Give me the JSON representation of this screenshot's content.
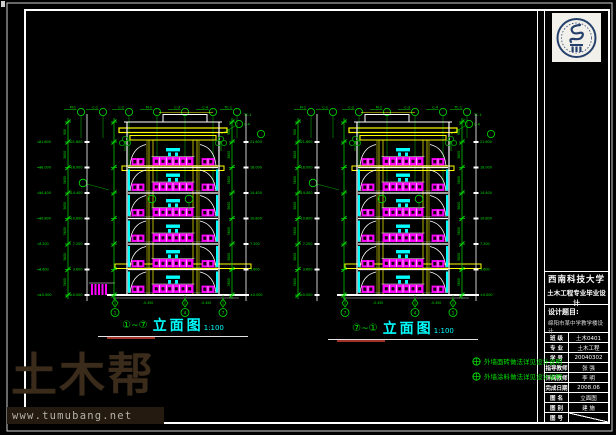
{
  "colors": {
    "bg": "#000000",
    "white": "#ffffff",
    "green": "#00E000",
    "magenta": "#FF00FF",
    "yellow": "#FFFF00",
    "cyan": "#00FFFF",
    "watermark_brown": "#3a2b1a"
  },
  "watermark": {
    "brand": "土木帮",
    "url": "www.tumubang.net"
  },
  "logo": {
    "alt": "西南科技大学校徽"
  },
  "title_block": {
    "university": "西南科技大学",
    "program": "土木工程专业毕业设计",
    "subject_label": "设计题目:",
    "subject": "绵阳市某中学教学楼设计",
    "rows": [
      {
        "label": "班 级",
        "value": "土木0401"
      },
      {
        "label": "专 业",
        "value": "土木工程"
      },
      {
        "label": "学 号",
        "value": "20040302"
      },
      {
        "label": "指导教师",
        "value": "张 强"
      },
      {
        "label": "评阅教师",
        "value": "李 明"
      },
      {
        "label": "完成日期",
        "value": "2008.06"
      },
      {
        "label": "图 名",
        "value": "立面图"
      },
      {
        "label": "图 别",
        "value": "建 施"
      },
      {
        "label": "图 号",
        "value": ""
      }
    ]
  },
  "elevations": [
    {
      "axis_from": "①",
      "tilde": "~",
      "axis_to": "⑦",
      "name": "立面图",
      "scale": "1:100"
    },
    {
      "axis_from": "⑦",
      "tilde": "~",
      "axis_to": "①",
      "name": "立面图",
      "scale": "1:100"
    }
  ],
  "notes": [
    {
      "text": "外墙面砖做法详见设计说明"
    },
    {
      "text": "外墙涂料做法详见设计说明"
    }
  ],
  "dims": {
    "floor_dim": "3600",
    "parapet_dim": "900",
    "levels": [
      "21.600",
      "18.000",
      "14.400",
      "10.800",
      "7.200",
      "3.600",
      "±0.000"
    ],
    "outside_level": "-0.450",
    "axes_left": [
      "1",
      "4",
      "7"
    ],
    "axes_right": [
      "7",
      "4",
      "1"
    ],
    "top_tags": [
      "M-1",
      "C-1",
      "C-2",
      "M-2",
      "C-3",
      "C-4",
      "TC-1"
    ]
  }
}
